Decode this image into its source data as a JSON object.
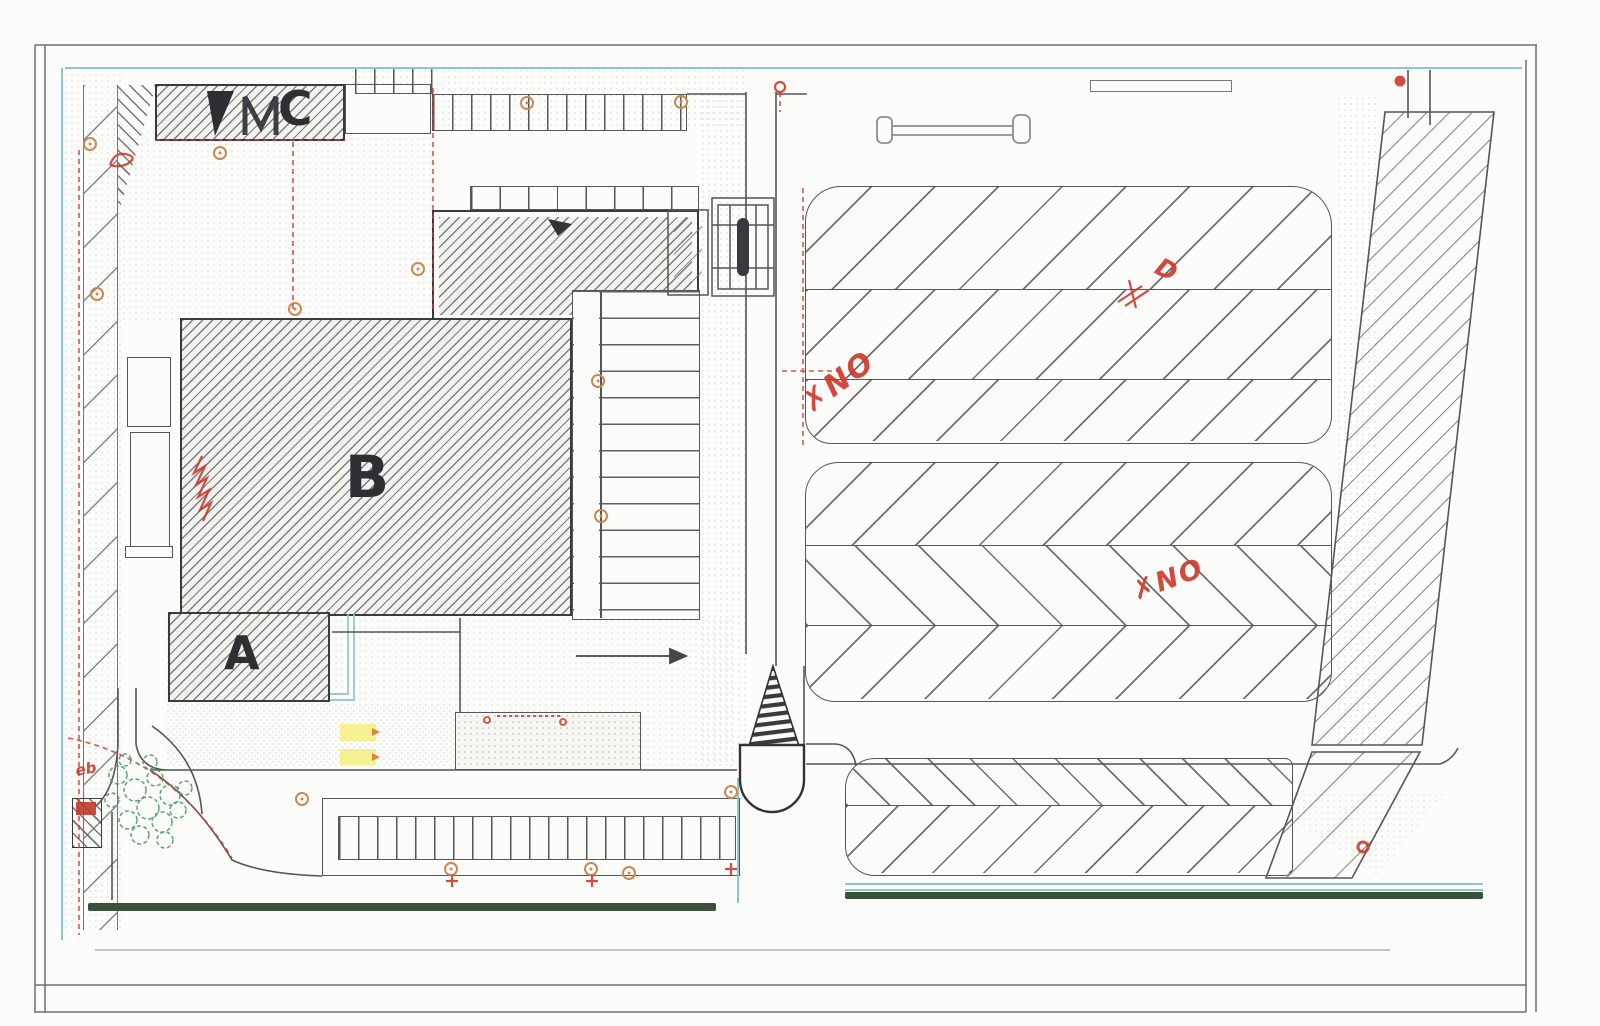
{
  "sheet": {
    "building_labels": {
      "a": "A",
      "b": "B",
      "c": "C"
    },
    "red_annotations": {
      "north_lot_note": "✗NO",
      "middle_lot_note": "✗NO",
      "planter_note": "eb",
      "loop_note": "D"
    },
    "colors": {
      "paper": "#fcfcfb",
      "linework": "#55555a",
      "building_ink": "#3b3b3f",
      "red_markup": "#cf3a2c",
      "teal_boundary": "#8fc6cc",
      "hedge_green": "#39503c",
      "shrub_green": "#4c9a66",
      "tree_orange": "#c98a52",
      "highlight_yellow": "#f5f07e"
    }
  }
}
